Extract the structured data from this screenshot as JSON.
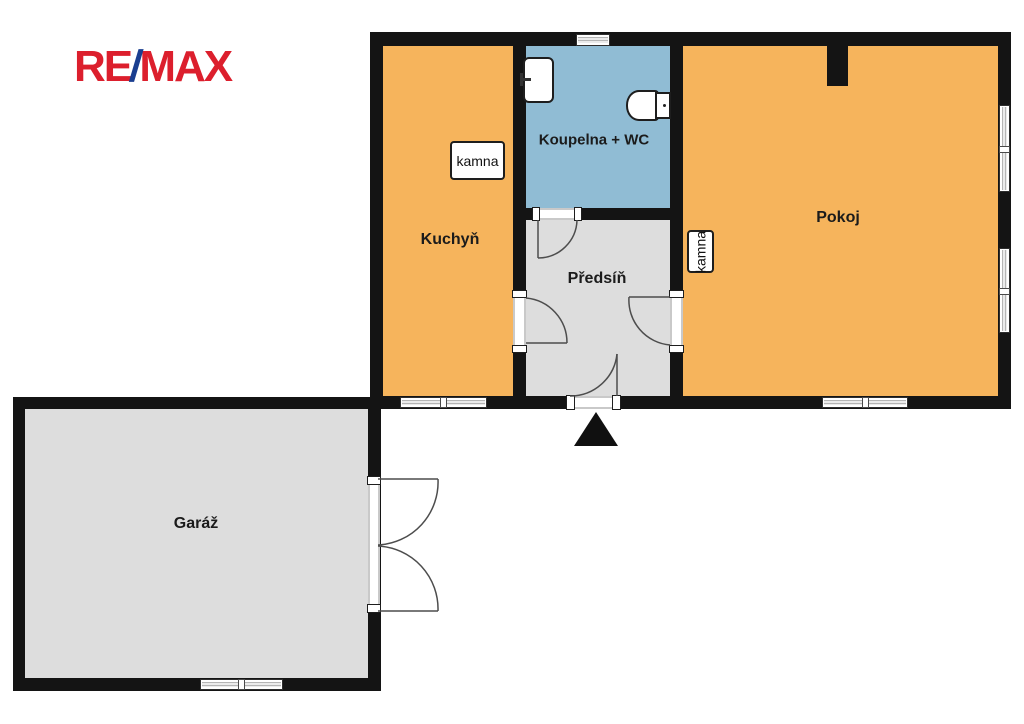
{
  "logo": {
    "part_re": "RE",
    "part_slash": "/",
    "part_max": "MAX",
    "color_red": "#DC1F2D",
    "color_blue": "#1A3E90"
  },
  "floorplan": {
    "rooms": {
      "kitchen": {
        "label": "Kuchyň",
        "fill": "#F6B45C"
      },
      "bathroom": {
        "label": "Koupelna + WC",
        "fill": "#90BCD4"
      },
      "hallway": {
        "label": "Předsíň",
        "fill": "#DDDDDD"
      },
      "livingroom": {
        "label": "Pokoj",
        "fill": "#F6B45C"
      },
      "garage": {
        "label": "Garáž",
        "fill": "#DDDDDD"
      }
    },
    "stoves": {
      "kitchen_stove": "kamna",
      "livingroom_stove": "kamna"
    },
    "colors": {
      "wall": "#141414",
      "background": "#FFFFFF",
      "door_stroke": "#4d4d4d"
    }
  }
}
